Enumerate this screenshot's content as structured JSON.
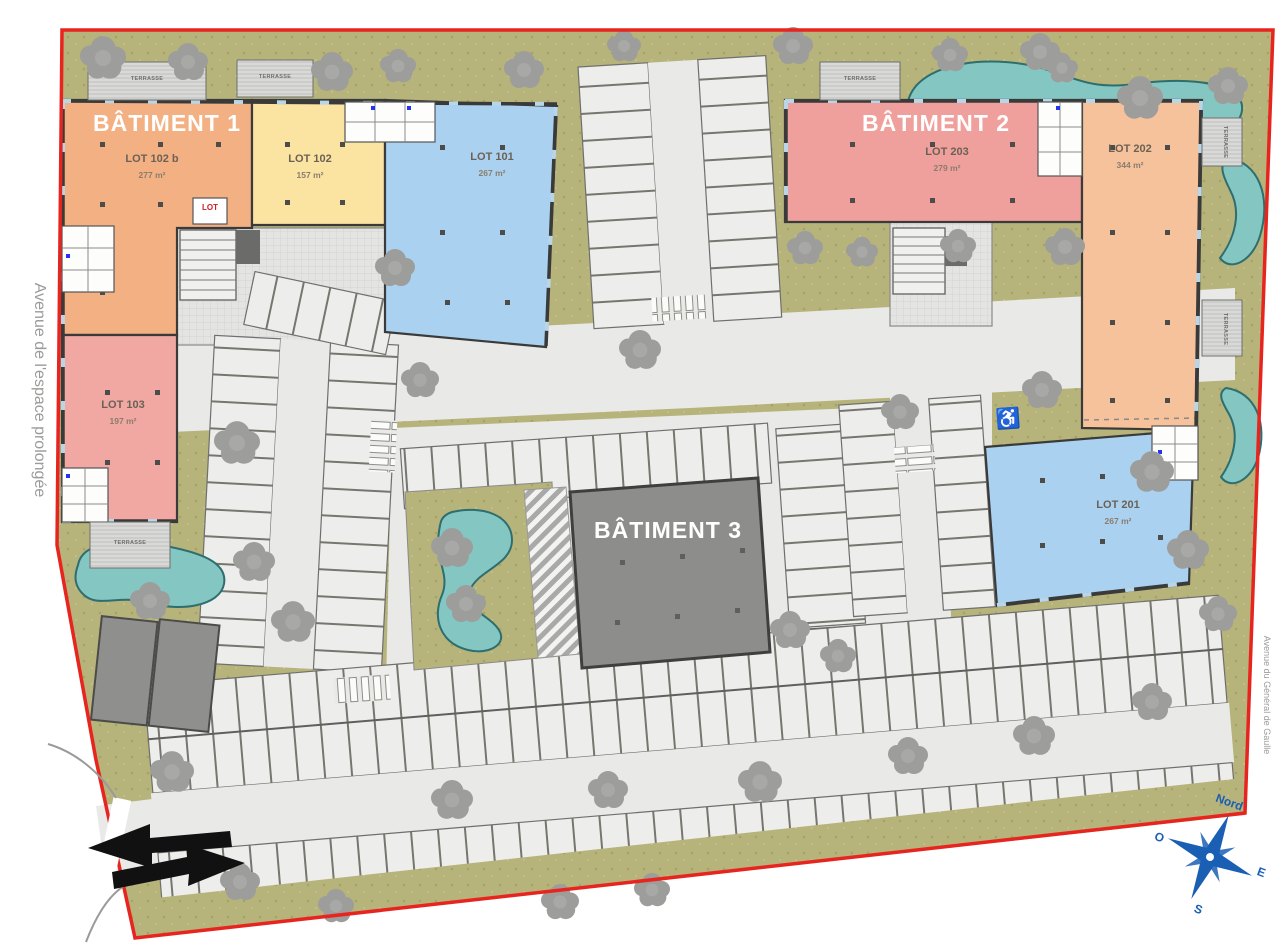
{
  "plan": {
    "streets": {
      "left": "Avenue de l'espace prolongée",
      "right": "Avenue du Général de Gaulle"
    },
    "compass": {
      "north": "Nord",
      "east": "E",
      "south": "S",
      "west": "O"
    },
    "buildings": {
      "b1": {
        "name": "BÂTIMENT 1"
      },
      "b2": {
        "name": "BÂTIMENT 2"
      },
      "b3": {
        "name": "BÂTIMENT 3"
      }
    },
    "lots": {
      "lot102b": {
        "label": "LOT 102 b",
        "area": "277 m²",
        "color": "#f3b083"
      },
      "lot102": {
        "label": "LOT 102",
        "area": "157 m²",
        "color": "#fbe3a1"
      },
      "lot101": {
        "label": "LOT 101",
        "area": "267 m²",
        "color": "#aad2f0"
      },
      "lot103": {
        "label": "LOT 103",
        "area": "197 m²",
        "color": "#f1a7a2"
      },
      "lot203": {
        "label": "LOT 203",
        "area": "279 m²",
        "color": "#efa09c"
      },
      "lot202": {
        "label": "LOT 202",
        "area": "344 m²",
        "color": "#f6c29b"
      },
      "lot201": {
        "label": "LOT 201",
        "area": "267 m²",
        "color": "#aad2f0"
      }
    },
    "annotations": {
      "terrace": "TERRASSE",
      "bike_room": "LOT",
      "handicap": "♿"
    },
    "colors": {
      "boundary": "#e8241f",
      "green": "#b6b37b",
      "road": "#e9e9e7",
      "pond": "#84c6c2",
      "pond_stroke": "#2e6e6e",
      "building3": "#8d8d8b",
      "compass": "#1a5fb4"
    }
  }
}
